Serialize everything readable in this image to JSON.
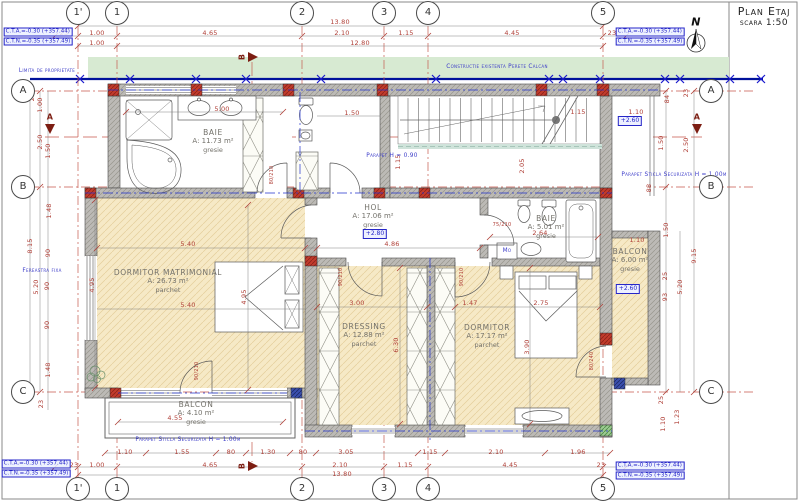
{
  "title": {
    "name": "Plan Etaj",
    "scale": "scara 1:50"
  },
  "benchmarks": {
    "cta": "C.T.A.=-0.30 (+357.44)",
    "ctn": "C.T.N.=-0.35 (+357.49)",
    "positions": [
      {
        "x": 38,
        "y": 37
      },
      {
        "x": 650,
        "y": 37
      },
      {
        "x": 36,
        "y": 469
      },
      {
        "x": 650,
        "y": 471
      }
    ]
  },
  "grid": {
    "cols": [
      {
        "label": "1'",
        "x": 78
      },
      {
        "label": "1",
        "x": 117
      },
      {
        "label": "2",
        "x": 302
      },
      {
        "label": "3",
        "x": 384
      },
      {
        "label": "4",
        "x": 428
      },
      {
        "label": "5",
        "x": 603
      }
    ],
    "rows": [
      {
        "label": "A",
        "y": 91
      },
      {
        "label": "B",
        "y": 187
      },
      {
        "label": "C",
        "y": 392
      }
    ],
    "top_y": 13,
    "bottom_y": 489,
    "left_x": 23,
    "right_x": 711
  },
  "rooms": [
    {
      "id": "baie-1",
      "name": "BAIE",
      "area": "A: 11.73 m²",
      "finish": "gresie",
      "x": 213,
      "y": 141
    },
    {
      "id": "hol",
      "name": "HOL",
      "area": "A: 17.06 m²",
      "finish": "gresie",
      "x": 373,
      "y": 216
    },
    {
      "id": "baie-2",
      "name": "BAIE",
      "area": "A: 5.01 m²",
      "finish": "gresie",
      "x": 546,
      "y": 227
    },
    {
      "id": "dormitor-matrimonial",
      "name": "DORMITOR MATRIMONIAL",
      "area": "A: 26.73 m²",
      "finish": "parchet",
      "x": 168,
      "y": 281
    },
    {
      "id": "dressing",
      "name": "DRESSING",
      "area": "A: 12.88 m²",
      "finish": "parchet",
      "x": 364,
      "y": 335
    },
    {
      "id": "dormitor",
      "name": "DORMITOR",
      "area": "A: 17.17 m²",
      "finish": "parchet",
      "x": 487,
      "y": 336
    },
    {
      "id": "balcon-dreapta",
      "name": "BALCON",
      "area": "A: 6.00 m²",
      "finish": "gresie",
      "x": 630,
      "y": 260
    },
    {
      "id": "balcon-jos",
      "name": "BALCON",
      "area": "A: 4.10 m²",
      "finish": "gresie",
      "x": 196,
      "y": 413
    }
  ],
  "levels": [
    {
      "t": "+2.80",
      "x": 375,
      "y": 234
    },
    {
      "t": "+2.60",
      "x": 630,
      "y": 121
    },
    {
      "t": "+2.60",
      "x": 628,
      "y": 289
    }
  ],
  "labels": [
    {
      "t": "13.80",
      "x": 340,
      "y": 22
    },
    {
      "t": "23",
      "x": 64,
      "y": 33
    },
    {
      "t": "1.00",
      "x": 97,
      "y": 33
    },
    {
      "t": "4.65",
      "x": 210,
      "y": 33
    },
    {
      "t": "2.10",
      "x": 342,
      "y": 33
    },
    {
      "t": "1.15",
      "x": 406,
      "y": 33
    },
    {
      "t": "4.45",
      "x": 512,
      "y": 33
    },
    {
      "t": "23",
      "x": 612,
      "y": 33
    },
    {
      "t": "1.00",
      "x": 97,
      "y": 43
    },
    {
      "t": "12.80",
      "x": 360,
      "y": 43
    },
    {
      "t": "1.10",
      "x": 125,
      "y": 452
    },
    {
      "t": "1.55",
      "x": 182,
      "y": 452
    },
    {
      "t": "80",
      "x": 231,
      "y": 452
    },
    {
      "t": "1.30",
      "x": 268,
      "y": 452
    },
    {
      "t": "80",
      "x": 303,
      "y": 452
    },
    {
      "t": "3.05",
      "x": 346,
      "y": 452
    },
    {
      "t": "1.15",
      "x": 430,
      "y": 452
    },
    {
      "t": "2.10",
      "x": 496,
      "y": 452
    },
    {
      "t": "1.96",
      "x": 578,
      "y": 452
    },
    {
      "t": "23",
      "x": 74,
      "y": 465
    },
    {
      "t": "1.00",
      "x": 97,
      "y": 465
    },
    {
      "t": "4.65",
      "x": 210,
      "y": 465
    },
    {
      "t": "2.10",
      "x": 340,
      "y": 465
    },
    {
      "t": "1.15",
      "x": 405,
      "y": 465
    },
    {
      "t": "4.45",
      "x": 510,
      "y": 465
    },
    {
      "t": "23",
      "x": 601,
      "y": 465
    },
    {
      "t": "13.80",
      "x": 342,
      "y": 474
    },
    {
      "t": "23",
      "x": 32,
      "y": 97,
      "r": -90
    },
    {
      "t": "1.00",
      "x": 40,
      "y": 105,
      "r": -90
    },
    {
      "t": "2.50",
      "x": 40,
      "y": 142,
      "r": -90
    },
    {
      "t": "1.50",
      "x": 48,
      "y": 151,
      "r": -90
    },
    {
      "t": "1.48",
      "x": 49,
      "y": 211,
      "r": -90
    },
    {
      "t": "8.15",
      "x": 30,
      "y": 246,
      "r": -90
    },
    {
      "t": "90",
      "x": 48,
      "y": 253,
      "r": -90
    },
    {
      "t": "5.20",
      "x": 36,
      "y": 287,
      "r": -90
    },
    {
      "t": "90",
      "x": 47,
      "y": 286,
      "r": -90
    },
    {
      "t": "90",
      "x": 47,
      "y": 325,
      "r": -90
    },
    {
      "t": "1.48",
      "x": 48,
      "y": 370,
      "r": -90
    },
    {
      "t": "23",
      "x": 41,
      "y": 404,
      "r": -90
    },
    {
      "t": "23",
      "x": 686,
      "y": 93,
      "r": -90
    },
    {
      "t": "84",
      "x": 667,
      "y": 99,
      "r": -90
    },
    {
      "t": "1.50",
      "x": 661,
      "y": 143,
      "r": -90
    },
    {
      "t": "2.50",
      "x": 686,
      "y": 145,
      "r": -90
    },
    {
      "t": "88",
      "x": 649,
      "y": 188,
      "r": -90
    },
    {
      "t": "1.50",
      "x": 666,
      "y": 230,
      "r": -90
    },
    {
      "t": "9.15",
      "x": 694,
      "y": 256,
      "r": -90
    },
    {
      "t": "25",
      "x": 665,
      "y": 276,
      "r": -90
    },
    {
      "t": "5.20",
      "x": 680,
      "y": 287,
      "r": -90
    },
    {
      "t": "93",
      "x": 665,
      "y": 297,
      "r": -90
    },
    {
      "t": "25",
      "x": 661,
      "y": 400,
      "r": -90
    },
    {
      "t": "1.10",
      "x": 663,
      "y": 424,
      "r": -90
    },
    {
      "t": "1.23",
      "x": 677,
      "y": 417,
      "r": -90
    },
    {
      "t": "5.00",
      "x": 222,
      "y": 109
    },
    {
      "t": "1.50",
      "x": 352,
      "y": 113
    },
    {
      "t": "1.15",
      "x": 578,
      "y": 112
    },
    {
      "t": "1.10",
      "x": 636,
      "y": 112
    },
    {
      "t": "1.15",
      "x": 398,
      "y": 162,
      "r": -90
    },
    {
      "t": "2.05",
      "x": 522,
      "y": 166,
      "r": -90
    },
    {
      "t": "2.64",
      "x": 540,
      "y": 233
    },
    {
      "t": "1.10",
      "x": 637,
      "y": 240
    },
    {
      "t": "5.40",
      "x": 188,
      "y": 244
    },
    {
      "t": "4.86",
      "x": 392,
      "y": 244
    },
    {
      "t": "5.40",
      "x": 188,
      "y": 305
    },
    {
      "t": "4.95",
      "x": 92,
      "y": 285,
      "r": -90
    },
    {
      "t": "4.95",
      "x": 244,
      "y": 297,
      "r": -90
    },
    {
      "t": "3.00",
      "x": 357,
      "y": 303
    },
    {
      "t": "1.47",
      "x": 470,
      "y": 303
    },
    {
      "t": "2.75",
      "x": 541,
      "y": 303
    },
    {
      "t": "6.30",
      "x": 396,
      "y": 345,
      "r": -90
    },
    {
      "t": "3.90",
      "x": 527,
      "y": 347,
      "r": -90
    },
    {
      "t": "4.55",
      "x": 175,
      "y": 418
    },
    {
      "t": "80/210",
      "x": 272,
      "y": 175,
      "r": -90,
      "cls": "dr",
      "n": "door-label-baie1"
    },
    {
      "t": "75/210",
      "x": 502,
      "y": 225,
      "cls": "dr",
      "n": "door-label-baie2"
    },
    {
      "t": "90/210",
      "x": 341,
      "y": 277,
      "r": -90,
      "cls": "dr",
      "n": "door-label-dressing"
    },
    {
      "t": "90/210",
      "x": 462,
      "y": 277,
      "r": -90,
      "cls": "dr",
      "n": "door-label-dormitor"
    },
    {
      "t": "90/210",
      "x": 197,
      "y": 371,
      "r": -90,
      "cls": "dr",
      "n": "door-label-balcon-jos"
    },
    {
      "t": "80/240",
      "x": 592,
      "y": 361,
      "r": -90,
      "cls": "dr",
      "n": "door-label-balcon-dreapta"
    },
    {
      "t": "Limita de proprietate",
      "x": 47,
      "y": 71,
      "cls": "note",
      "n": "note-limita-de-proprietate"
    },
    {
      "t": "Constructie existenta Perete Calcan",
      "x": 497,
      "y": 67,
      "cls": "note",
      "n": "note-constructie-existenta"
    },
    {
      "t": "Parapet H = 0.90",
      "x": 392,
      "y": 156,
      "cls": "note",
      "n": "note-parapet-090"
    },
    {
      "t": "Parapet Sticla Securizata H = 1.00m",
      "x": 674,
      "y": 175,
      "cls": "note",
      "n": "note-parapet-sticla-dreapta"
    },
    {
      "t": "Parapet Sticla Securizata H = 1.00m",
      "x": 188,
      "y": 440,
      "cls": "note",
      "n": "note-parapet-sticla-jos"
    },
    {
      "t": "Fereastra fixa",
      "x": 42,
      "y": 271,
      "cls": "note",
      "n": "note-fereastra-fixa"
    },
    {
      "t": "Mo",
      "x": 507,
      "y": 251,
      "cls": "note",
      "n": "washing-machine-label"
    },
    {
      "t": "A",
      "x": 50,
      "y": 117,
      "cls": "sec",
      "n": "section-marker-a-left"
    },
    {
      "t": "A",
      "x": 697,
      "y": 117,
      "cls": "sec",
      "n": "section-marker-a-right"
    },
    {
      "t": "B",
      "x": 242,
      "y": 57,
      "r": -90,
      "cls": "sec",
      "n": "section-marker-b-top"
    },
    {
      "t": "B",
      "x": 242,
      "y": 466,
      "r": -90,
      "cls": "sec",
      "n": "section-marker-b-bottom"
    },
    {
      "t": "N",
      "x": 696,
      "y": 22,
      "cls": "north",
      "n": "north-label"
    }
  ],
  "colors": {
    "accent_blue": "#3b3bc8",
    "dim_red": "#b04038",
    "axis_red": "#c65a4e",
    "wall_gray": "#bcbab6",
    "floor_beige": "#f6e9c6",
    "green_band": "#d7ead2",
    "boundary_blue": "#00119b"
  }
}
